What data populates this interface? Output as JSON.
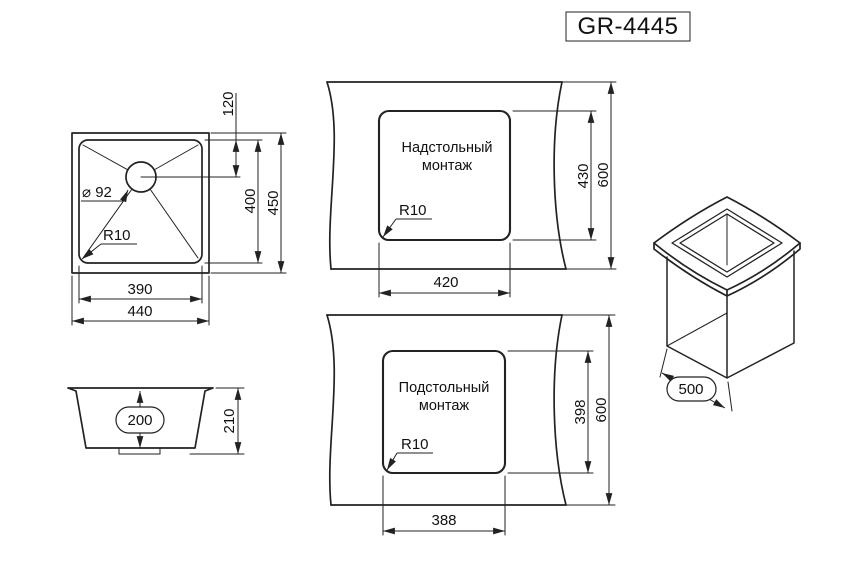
{
  "title": "GR-4445",
  "colors": {
    "line": "#222222",
    "background": "#ffffff"
  },
  "top_view": {
    "drain_offset": "120",
    "bowl_length": "400",
    "overall_length": "450",
    "bowl_width": "390",
    "overall_width": "440",
    "drain_diameter": "⌀ 92",
    "corner_radius": "R10"
  },
  "side_view": {
    "bowl_depth": "200",
    "overall_height": "210"
  },
  "surface_mount": {
    "label_line1": "Надстольный",
    "label_line2": "монтаж",
    "corner_radius": "R10",
    "cutout_width": "420",
    "cutout_length": "430",
    "counter_depth": "600"
  },
  "under_mount": {
    "label_line1": "Подстольный",
    "label_line2": "монтаж",
    "corner_radius": "R10",
    "cutout_width": "388",
    "cutout_length": "398",
    "counter_depth": "600"
  },
  "iso_view": {
    "cabinet_width": "500"
  }
}
